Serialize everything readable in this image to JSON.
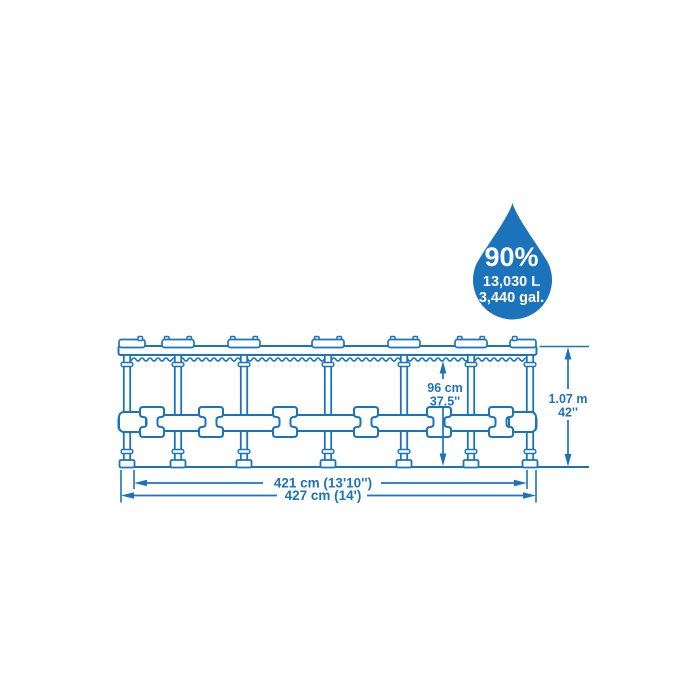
{
  "colors": {
    "diagram_blue": "#1b74bb",
    "background": "#ffffff",
    "text_on_drop": "#ffffff"
  },
  "capacity_drop": {
    "percent": "90%",
    "liters": "13,030 L",
    "gallons": "3,440 gal."
  },
  "dimensions": {
    "water_depth": {
      "metric": "96 cm",
      "imperial": "37.5''"
    },
    "frame_height": {
      "metric": "1.07 m",
      "imperial": "42''"
    },
    "inner_diameter": "421 cm (13'10'')",
    "outer_diameter": "427 cm (14')"
  }
}
